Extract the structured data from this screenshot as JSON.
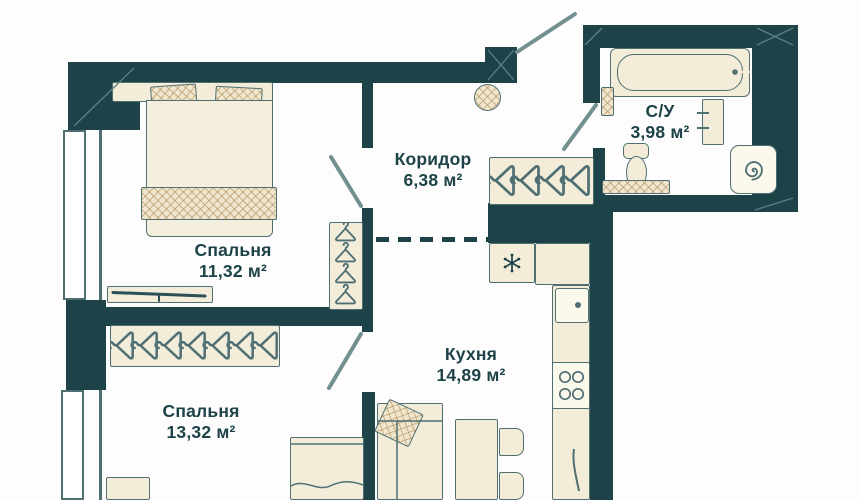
{
  "rooms": [
    {
      "name": "Спальня",
      "area": "11,32 м²"
    },
    {
      "name": "Коридор",
      "area": "6,38 м²"
    },
    {
      "name": "С/У",
      "area": "3,98 м²"
    },
    {
      "name": "Кухня",
      "area": "14,89 м²"
    },
    {
      "name": "Спальня",
      "area": "13,32 м²"
    }
  ],
  "colors": {
    "wall": "#1d4348",
    "furniture_fill": "#f2ecd9",
    "furniture_outline": "#4f6f73",
    "textile": "#efe6cd",
    "text": "#1d4348",
    "background": "#fdfdfd"
  },
  "icons": {
    "wardrobe": "hanger-icon",
    "fridge": "snowflake-icon",
    "washing_machine": "spiral-icon",
    "stove": "burners-icon"
  }
}
